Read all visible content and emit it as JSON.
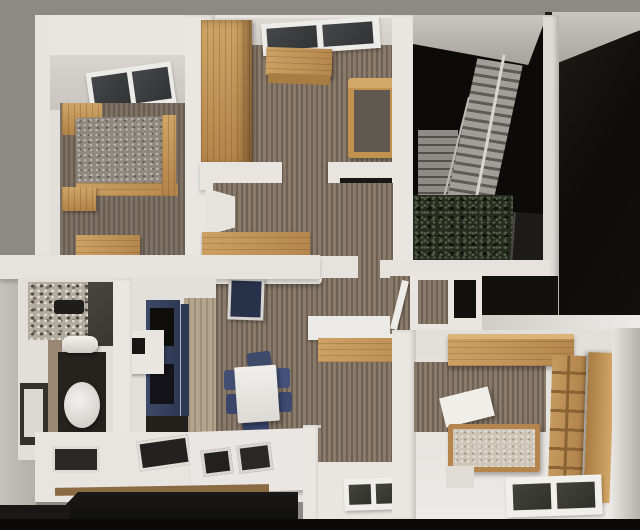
{
  "scene": {
    "type": "3d-floorplan-model-render",
    "view": "top-down",
    "description": "Top-down photorealistic render of a miniature apartment model with white walls, wood-plank floors, skylights, a staircase against a black wall, kitchen, bathroom, dining area and two bedrooms.",
    "rooms": [
      {
        "name": "bedroom-top-left",
        "objects": [
          "skylight-window",
          "double-bed",
          "gray-blanket",
          "wood-headboard",
          "nightstand",
          "wood-bench"
        ]
      },
      {
        "name": "bedroom-top-middle",
        "objects": [
          "wardrobe",
          "desk",
          "single-bed",
          "skylight-window"
        ]
      },
      {
        "name": "stairwell",
        "objects": [
          "staircase",
          "side-stairs",
          "white-railing",
          "plants",
          "tv-panel",
          "black-wall"
        ]
      },
      {
        "name": "hallway",
        "objects": [
          "cubby-shelf",
          "open-door",
          "black-floor",
          "white-floor-strip"
        ]
      },
      {
        "name": "bathroom",
        "objects": [
          "granite-counter",
          "dark-tiles",
          "toilet",
          "washing-machine",
          "towel-roll",
          "dark-vanity"
        ]
      },
      {
        "name": "kitchen",
        "objects": [
          "navy-cabinet",
          "glass-panels",
          "white-counter",
          "light-wood-floor",
          "dark-base"
        ]
      },
      {
        "name": "living-dining",
        "objects": [
          "sofa",
          "corner-shelf",
          "tv",
          "dining-table",
          "six-navy-chairs",
          "console-bench",
          "kitchen-island",
          "cooktop-insets"
        ]
      },
      {
        "name": "bedroom-bottom-right",
        "objects": [
          "wardrobe-slab",
          "bookshelf",
          "bed",
          "white-desk",
          "floor-window",
          "step"
        ]
      },
      {
        "name": "bottom-strip",
        "objects": [
          "white-counter",
          "window-insets",
          "wood-trim",
          "black-cabinet"
        ]
      }
    ],
    "palette": {
      "outer_wall_gray": "#8d8a86",
      "wall_white": "#eae7e3",
      "wall_shadow": "#cfcbc5",
      "floor_stripe_light": "#8a7a6a",
      "floor_stripe_dark": "#6e6052",
      "oak_light": "#d0a466",
      "oak_dark": "#b2834a",
      "navy_cabinet": "#36425f",
      "navy_chair": "#3d4a6a",
      "black_zone": "#0e0c09",
      "stair_tread": "#a19e99",
      "plant_green": "#2a3023",
      "granite": "#b2aca0",
      "blanket_gray": "#8e887e",
      "mattress_beige": "#cdc5b5",
      "window_pane": "#3a3d3b",
      "cabinet_black": "#141312"
    }
  }
}
